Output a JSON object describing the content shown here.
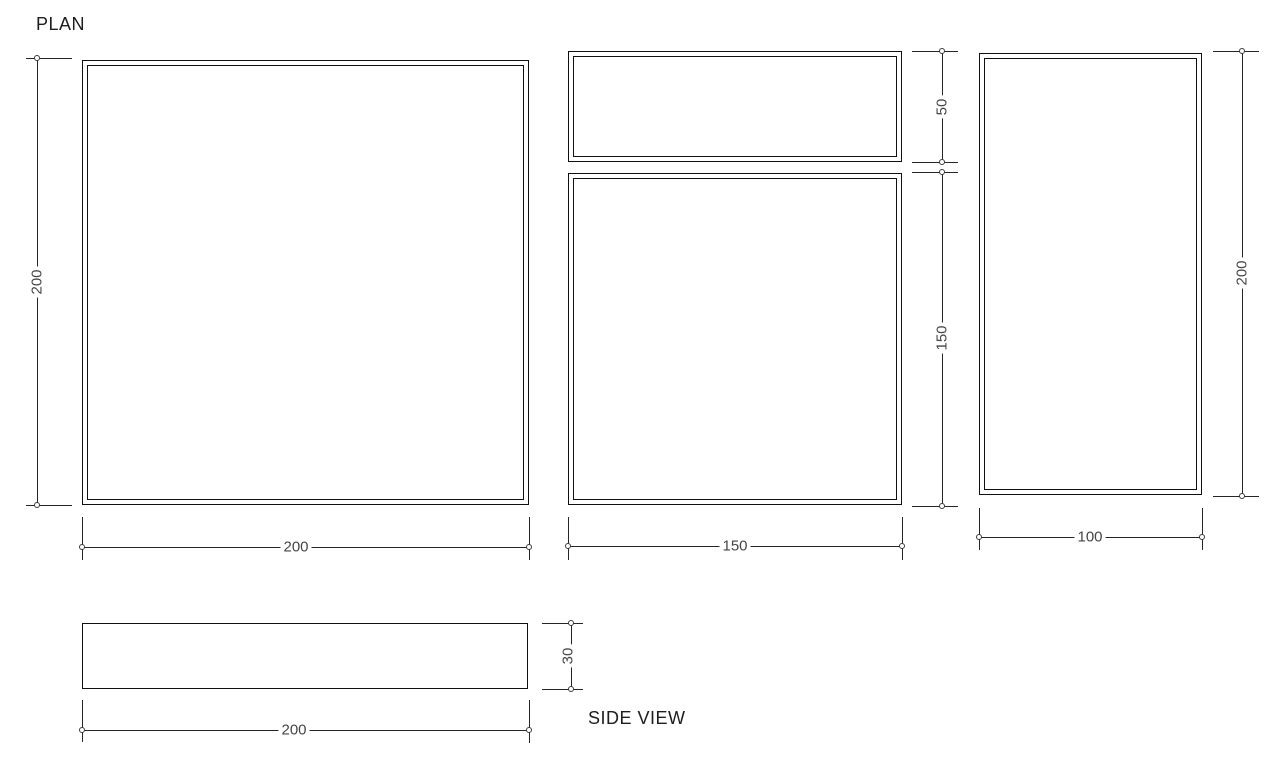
{
  "labels": {
    "plan": "PLAN",
    "side_view": "SIDE VIEW"
  },
  "dimensions": {
    "plan_height": "200",
    "plan_width": "200",
    "mid_top_height": "50",
    "mid_bottom_height": "150",
    "mid_width": "150",
    "right_height": "200",
    "right_width": "100",
    "side_view_thickness": "30",
    "side_view_width": "200"
  },
  "colors": {
    "background": "#ffffff",
    "outline": "#101010",
    "dimension_line": "#262626",
    "dimension_text": "#464646"
  }
}
